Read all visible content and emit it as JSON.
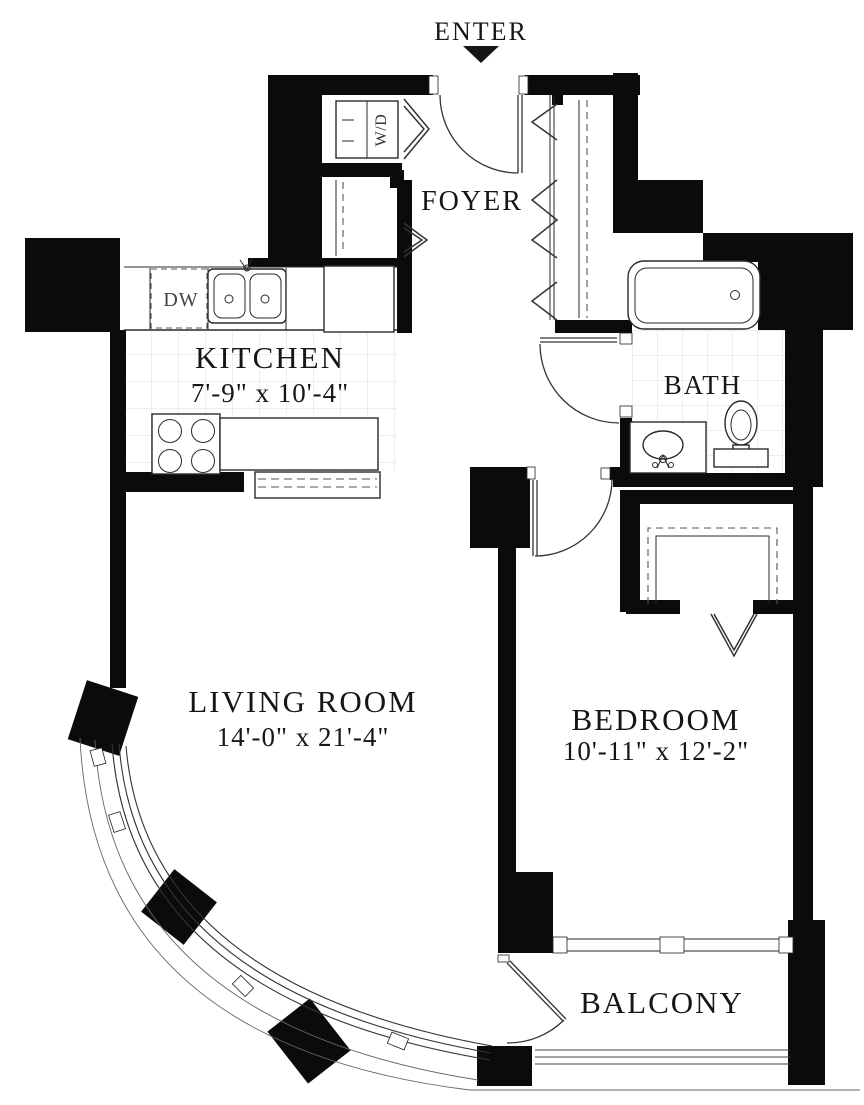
{
  "title": "Apartment floor plan",
  "entry": {
    "label": "ENTER"
  },
  "rooms": [
    {
      "name": "FOYER",
      "dims": ""
    },
    {
      "name": "KITCHEN",
      "dims": "7'-9\" x 10'-4\""
    },
    {
      "name": "BATH",
      "dims": ""
    },
    {
      "name": "LIVING ROOM",
      "dims": "14'-0\" x 21'-4\""
    },
    {
      "name": "BEDROOM",
      "dims": "10'-11\" x 12'-2\""
    },
    {
      "name": "BALCONY",
      "dims": ""
    }
  ],
  "appliances": {
    "washer_dryer": "W/D",
    "dishwasher": "DW"
  },
  "colors": {
    "wall": "#0b0b0b",
    "line": "#2a2a2a",
    "tile": "#d8d8d8",
    "background": "#ffffff"
  }
}
